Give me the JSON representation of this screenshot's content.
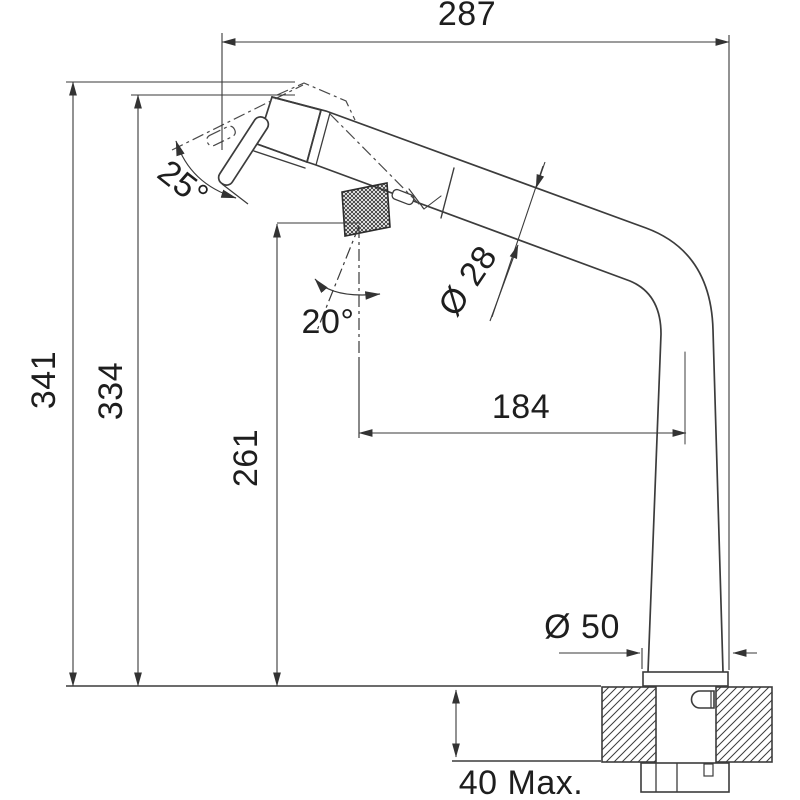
{
  "drawing": {
    "type": "technical-dimension-drawing",
    "subject": "pull-out kitchen tap side elevation with installation dimensions",
    "background_color": "#ffffff",
    "line_color": "#3c3c3c",
    "text_color": "#1e1e1e",
    "labels": {
      "width_overall": "287",
      "height_overall": "341",
      "height_spout": "334",
      "height_handle": "261",
      "spout_reach": "184",
      "spout_diameter": "Ø 28",
      "base_diameter": "Ø 50",
      "deck_thickness": "40 Max.",
      "spray_head_angle": "25°",
      "handle_angle": "20°"
    }
  }
}
